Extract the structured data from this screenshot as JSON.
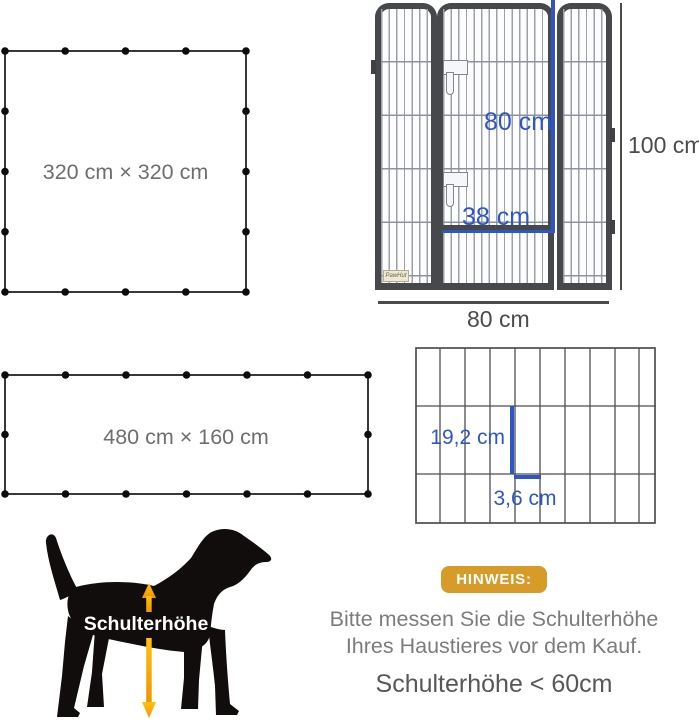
{
  "layouts": {
    "square": {
      "size_label": "320 cm × 320 cm"
    },
    "rectangle": {
      "size_label": "480 cm × 160 cm"
    }
  },
  "panel_diagram": {
    "door_height": "80 cm",
    "door_width": "38 cm",
    "panel_height": "100 cm",
    "panel_width": "80 cm",
    "brand": "PawHut"
  },
  "mesh_diagram": {
    "vertical_gap": "19,2 cm",
    "horizontal_gap": "3,6 cm"
  },
  "dog_diagram": {
    "label": "Schulterhöhe"
  },
  "notice": {
    "badge": "HINWEIS:",
    "line1": "Bitte messen Sie die Schulterhöhe",
    "line2": "Ihres Haustieres vor dem Kauf.",
    "line3": "Schulterhöhe < 60cm"
  },
  "colors": {
    "measure_blue": "#2d56c7",
    "badge_gold": "#d69b28",
    "arrow_orange": "#f7a60f",
    "frame_dark": "#46484b"
  }
}
